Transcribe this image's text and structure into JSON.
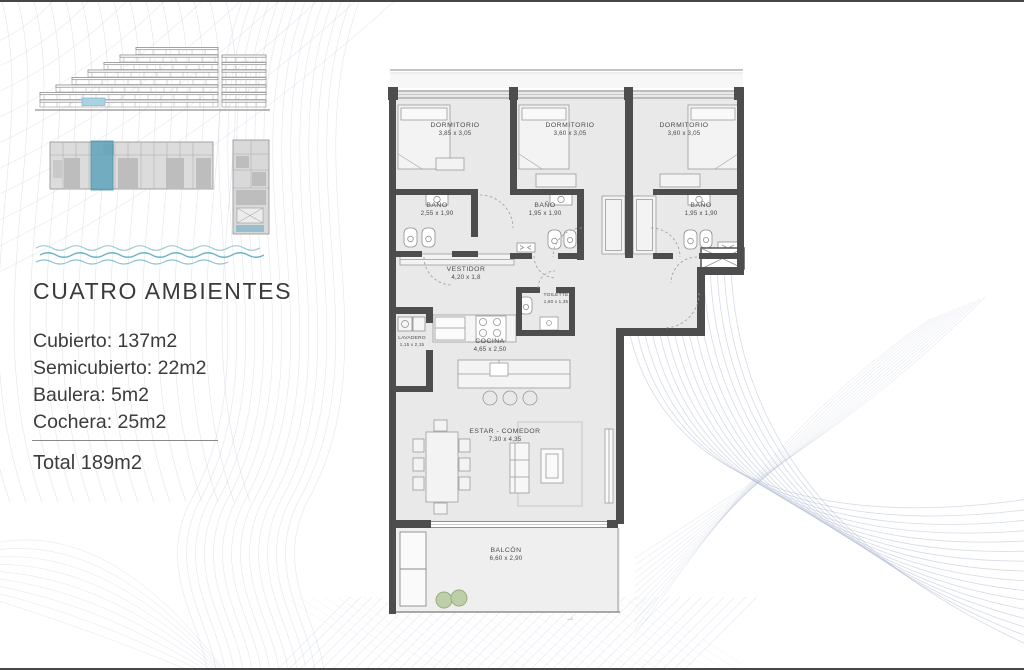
{
  "left_panel": {
    "title": "CUATRO AMBIENTES",
    "areas": [
      "Cubierto: 137m2",
      "Semicubierto: 22m2",
      "Baulera: 5m2",
      "Cochera: 25m2"
    ],
    "total": "Total 189m2"
  },
  "plan": {
    "rooms": [
      {
        "name": "DORMITORIO",
        "dims": "3,85 x 3,05"
      },
      {
        "name": "DORMITORIO",
        "dims": "3,60 x 3,05"
      },
      {
        "name": "DORMITORIO",
        "dims": "3,60 x 3,05"
      },
      {
        "name": "BAÑO",
        "dims": "2,55 x 1,90"
      },
      {
        "name": "BAÑO",
        "dims": "1,95 x 1,90"
      },
      {
        "name": "BAÑO",
        "dims": "1,95 x 1,90"
      },
      {
        "name": "VESTIDOR",
        "dims": "4,20 x 1,8"
      },
      {
        "name": "TOILETTE",
        "dims": "1,60 x 1,35"
      },
      {
        "name": "LAVADERO",
        "dims": "1,15 x 2,15"
      },
      {
        "name": "COCINA",
        "dims": "4,65 x 2,50"
      },
      {
        "name": "ESTAR - COMEDOR",
        "dims": "7,30 x 4,35"
      },
      {
        "name": "BALCÓN",
        "dims": "6,60 x 2,90"
      }
    ]
  },
  "deco": {
    "watermark": "o 7"
  },
  "colors": {
    "wall": "#4d4d4d",
    "room_fill": "#e9e9e9",
    "highlight_unit_teal": "#5ea3bc",
    "elevation_highlight_blue": "#a9d3e2",
    "wave_blue": "#6fb3c8",
    "deco_line": "#b9c3d6",
    "plant_green": "#bccfa8"
  }
}
